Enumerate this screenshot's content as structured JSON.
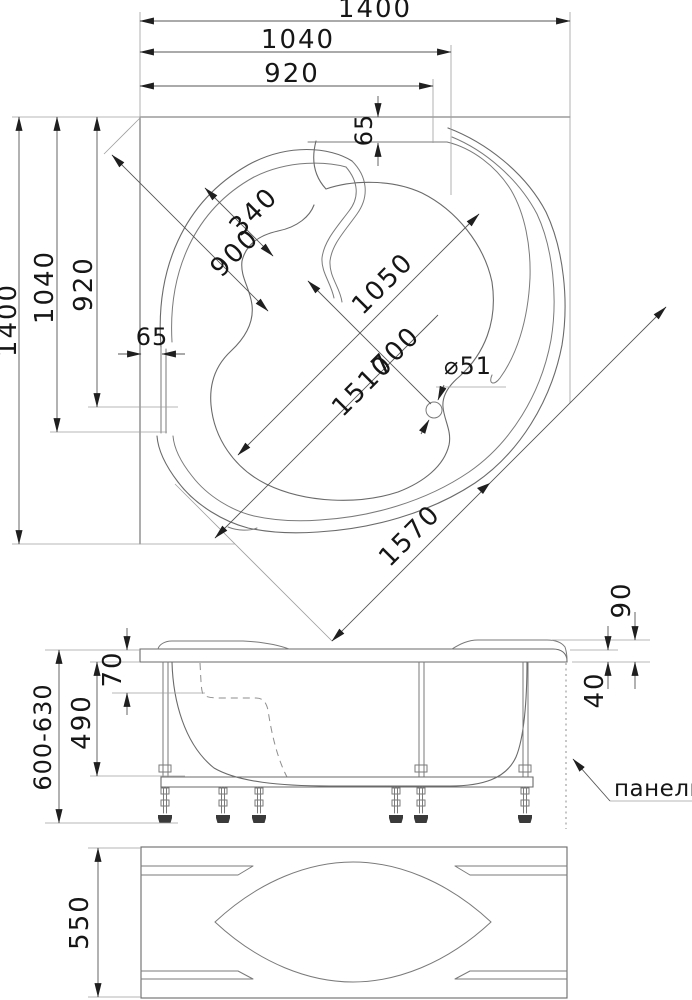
{
  "drawing": {
    "type": "technical-drawing",
    "subject": "corner bathtub with frame and front panel",
    "views": [
      "plan",
      "side-elevation",
      "front-panel"
    ],
    "units": "mm"
  },
  "colors": {
    "background": "#ffffff",
    "drawing_line": "#6a6a6a",
    "construction_line": "#9f9f9f",
    "dimension_line": "#555555",
    "text": "#161616",
    "foot_pad": "#3a3a3a"
  },
  "dims": {
    "plan_1400_h": "1400",
    "plan_1040_h": "1040",
    "plan_920_h": "920",
    "plan_65_top": "65",
    "plan_340": "340",
    "plan_900": "900",
    "plan_1050": "1050",
    "plan_700": "700",
    "plan_1510": "1510",
    "plan_65_left": "65",
    "plan_1400_v": "1400",
    "plan_1040_v": "1040",
    "plan_920_v": "920",
    "plan_drain": "⌀51",
    "plan_1570": "1570",
    "side_90": "90",
    "side_40": "40",
    "side_70": "70",
    "side_490": "490",
    "side_range": "600-630",
    "side_panel_label": "панель",
    "front_550": "550"
  }
}
